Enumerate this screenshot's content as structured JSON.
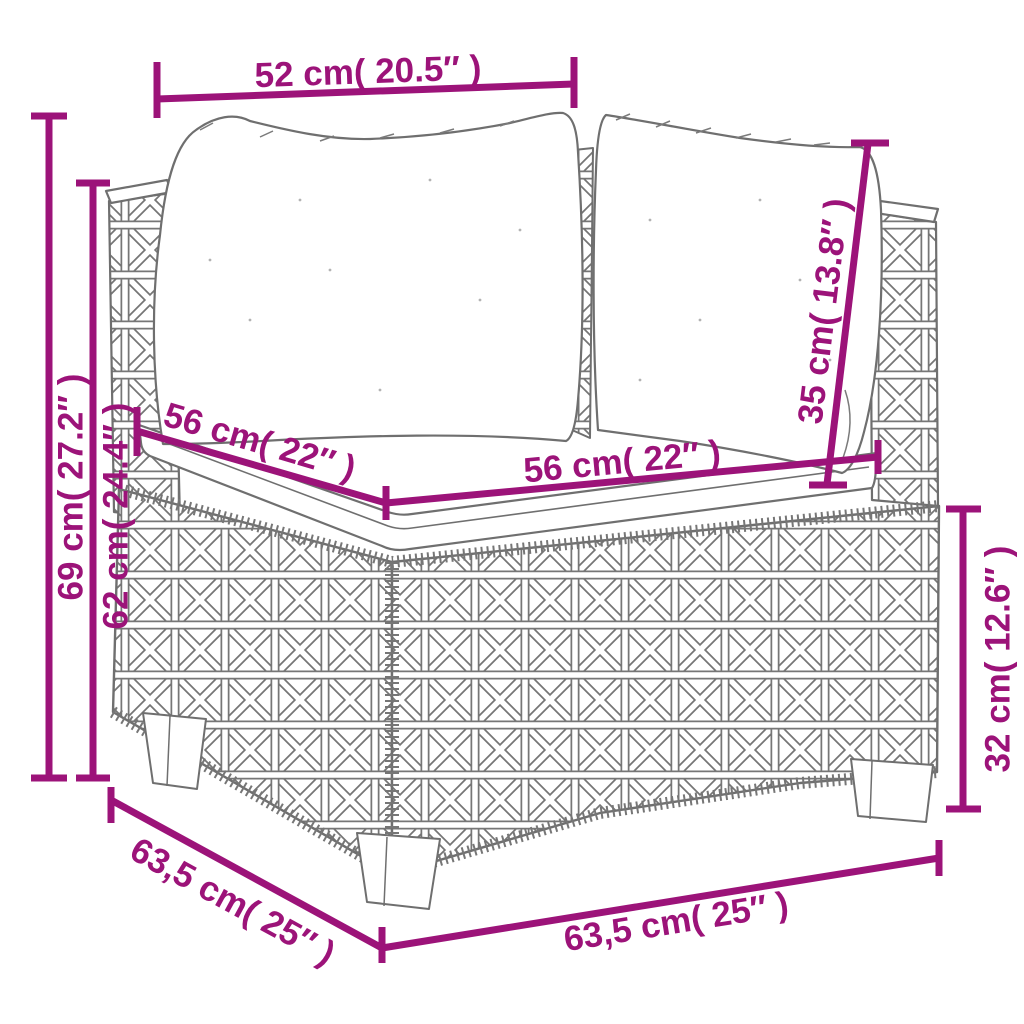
{
  "diagram": {
    "type": "product-dimension-diagram",
    "subject": "poly-rattan corner sofa section with back cushions and seat cushion",
    "colors": {
      "dimension_accent": "#9C1379",
      "sketch_line": "#6F6F6F",
      "background": "#FFFFFF"
    },
    "dimensions": [
      {
        "id": "top-width",
        "label": "52 cm( 20.5″ )"
      },
      {
        "id": "overall-height",
        "label": "69 cm( 27.2″ )"
      },
      {
        "id": "armrest-height",
        "label": "62 cm( 24.4″ )"
      },
      {
        "id": "seat-depth",
        "label": "56 cm( 22″ )"
      },
      {
        "id": "seat-width",
        "label": "56 cm( 22″ )"
      },
      {
        "id": "back-cushion-height",
        "label": "35 cm( 13.8″ )"
      },
      {
        "id": "base-height",
        "label": "32 cm( 12.6″ )"
      },
      {
        "id": "overall-depth",
        "label": "63,5 cm( 25″ )"
      },
      {
        "id": "overall-width",
        "label": "63,5 cm( 25″ )"
      }
    ]
  }
}
